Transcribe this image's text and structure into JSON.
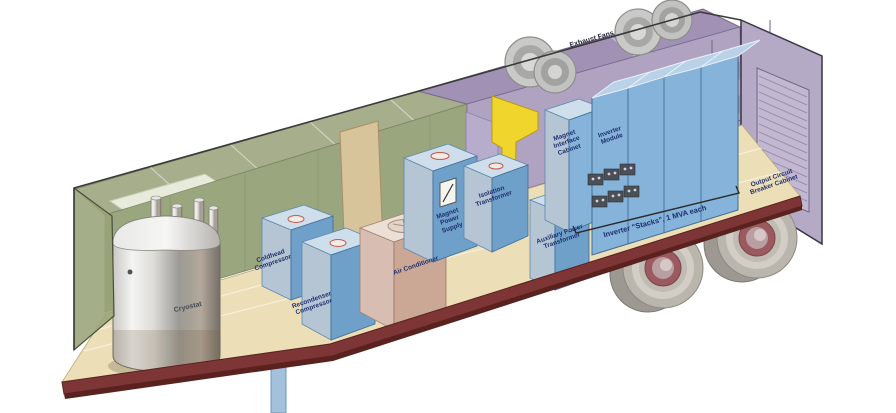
{
  "illustration": {
    "title_hint": "Cutaway view of trailer-mounted power conversion system",
    "labels": {
      "cryostat": "Cryostat",
      "coldhead_compressor": "Coldhead Compressor",
      "recondenser_compressor": "Recondenser Compressor",
      "air_conditioner": "Air Conditioner",
      "magnet_power_supply": "Magnet Power Supply",
      "isolation_transformer": "Isolation Transformer",
      "auxiliary_power_transformer": "Auxiliary Power Transformer",
      "magnet_interface_cabinet": "Magnet Interface Cabinet",
      "inverter_module": "Inverter Module",
      "exhaust_fans": "Exhaust Fans",
      "inverter_stacks_note": "Inverter \"Stacks\", 1 MVA each",
      "output_circuit_breaker_cabinet": "Output Circuit Breaker Cabinet"
    },
    "colors": {
      "wall_green": "#9aa67e",
      "ceiling_green": "#a6ae8c",
      "roof_purple": "#a192b5",
      "wall_purple": "#b0a3c2",
      "rear_door_lavender": "#b5aac6",
      "floor_tan": "#ecdfb8",
      "floor_rim_maroon": "#7e3535",
      "equipment_blue_front": "#6fa0ca",
      "equipment_blue_side": "#b6c5d4",
      "equipment_blue_top": "#cfdeeb",
      "inverter_blue": "#85b3da",
      "ac_pink": "#cba795",
      "bulkhead_yellow": "#f0d52c",
      "door_tan": "#d8c49a",
      "label_navy": "#1e2f6e",
      "wheel_gray": "#bab6ae",
      "hub_maroon": "#9a5a60"
    }
  }
}
